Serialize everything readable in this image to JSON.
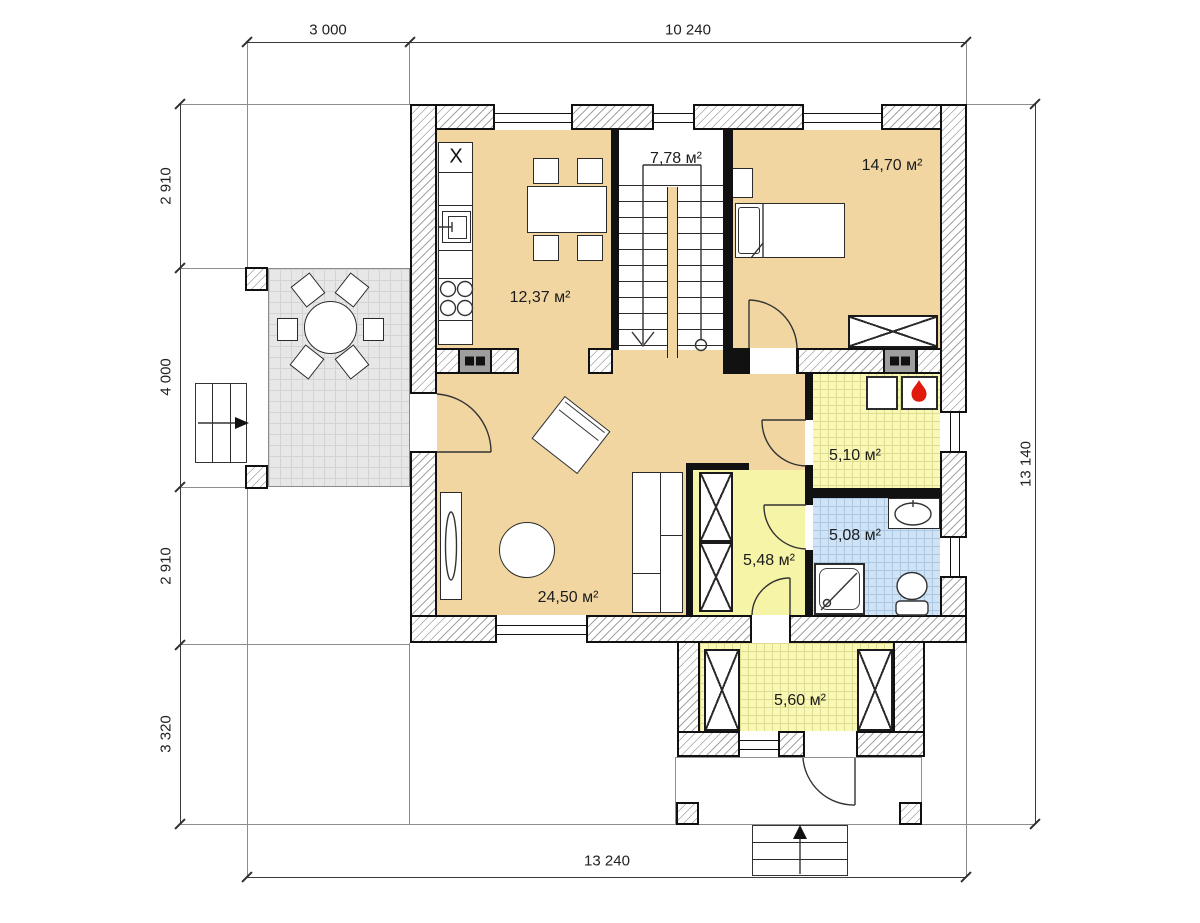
{
  "rooms": {
    "kitchen": {
      "area": "12,37 м²"
    },
    "stair_hall": {
      "area": "7,78 м²"
    },
    "bedroom": {
      "area": "14,70 м²"
    },
    "living": {
      "area": "24,50 м²"
    },
    "boiler": {
      "area": "5,10 м²"
    },
    "bathroom": {
      "area": "5,08 м²"
    },
    "hallway": {
      "area": "5,48 м²"
    },
    "entry": {
      "area": "5,60 м²"
    }
  },
  "dimensions": {
    "top": [
      "3 000",
      "10 240"
    ],
    "left": [
      "2 910",
      "4 000",
      "2 910",
      "3 320"
    ],
    "right": "13 140",
    "bottom": "13 240"
  },
  "symbols": {
    "fridge": "X"
  },
  "colors": {
    "floor_wood": "#f2d6a2",
    "tile_yellow": "#f9f8b6",
    "tile_yellow_grid": "#dedc8e",
    "tile_yellow_plain": "#f6f4a6",
    "tile_blue": "#cfe3f5",
    "tile_blue_grid": "#aac8e4",
    "terrace": "#e7e7e7",
    "terrace_grid": "#d3d3d3",
    "wall_line": "#111111",
    "hatch": "#a3a3a3",
    "flame": "#e11a0e",
    "dim": "#3a3a3a"
  }
}
